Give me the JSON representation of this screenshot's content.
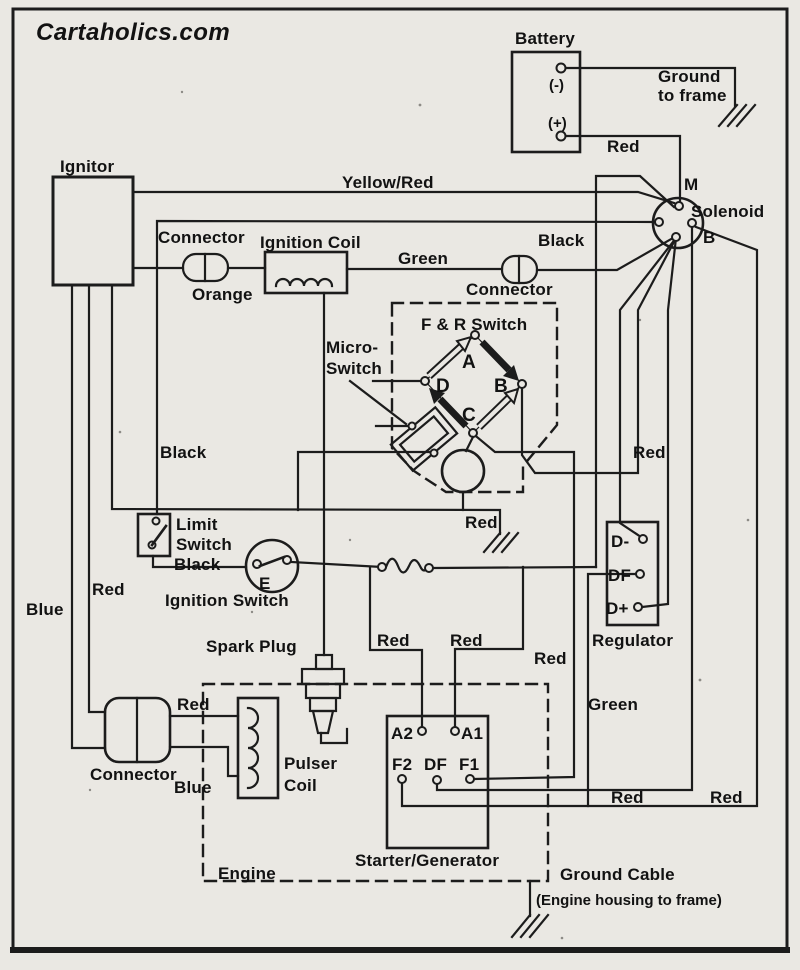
{
  "page": {
    "background": "#eae8e3",
    "line_color": "#1c1c1c",
    "text_color": "#121212"
  },
  "logo": {
    "text": "Cartaholics.com"
  },
  "diagram": {
    "components": {
      "battery": {
        "label": "Battery",
        "terminals": {
          "negative": "(-)",
          "positive": "(+)"
        }
      },
      "solenoid": {
        "label": "Solenoid",
        "terminals": {
          "m": "M",
          "b": "B"
        }
      },
      "ignitor": {
        "label": "Ignitor"
      },
      "connector_top": {
        "label": "Connector"
      },
      "ignition_coil": {
        "label": "Ignition Coil"
      },
      "connector_mid": {
        "label": "Connector"
      },
      "f_r_switch": {
        "label": "F & R Switch",
        "terminals": {
          "a": "A",
          "b": "B",
          "c": "C",
          "d": "D"
        }
      },
      "micro_switch": {
        "label_line1": "Micro-",
        "label_line2": "Switch"
      },
      "limit_switch": {
        "label_line1": "Limit",
        "label_line2": "Switch"
      },
      "ignition_switch": {
        "label": "Ignition Switch",
        "terminal": "E"
      },
      "spark_plug": {
        "label": "Spark Plug"
      },
      "pulser_coil": {
        "label_line1": "Pulser",
        "label_line2": "Coil"
      },
      "connector_bottom": {
        "label": "Connector"
      },
      "starter_generator": {
        "label": "Starter/Generator",
        "terminals": {
          "a2": "A2",
          "a1": "A1",
          "f2": "F2",
          "df": "DF",
          "f1": "F1"
        }
      },
      "regulator": {
        "label": "Regulator",
        "terminals": {
          "d_minus": "D-",
          "df": "DF",
          "d_plus": "D+"
        }
      },
      "engine": {
        "label": "Engine"
      }
    },
    "wire_labels": {
      "yellow_red": "Yellow/Red",
      "black_solenoid": "Black",
      "green_coil": "Green",
      "orange": "Orange",
      "red_battery": "Red",
      "black_ignitor": "Black",
      "black_limit": "Black",
      "blue_ignitor": "Blue",
      "red_ignitor": "Red",
      "red_fr_ground": "Red",
      "red_regulator": "Red",
      "red_a2": "Red",
      "red_a1": "Red",
      "red_a1_corner": "Red",
      "red_connector": "Red",
      "blue_connector": "Blue",
      "green_field": "Green",
      "red_f2_run": "Red",
      "red_f2_run_right": "Red"
    },
    "annotations": {
      "ground_to_frame_line1": "Ground",
      "ground_to_frame_line2": "to frame",
      "ground_cable": "Ground Cable",
      "ground_cable_sub": "(Engine housing to frame)"
    }
  }
}
